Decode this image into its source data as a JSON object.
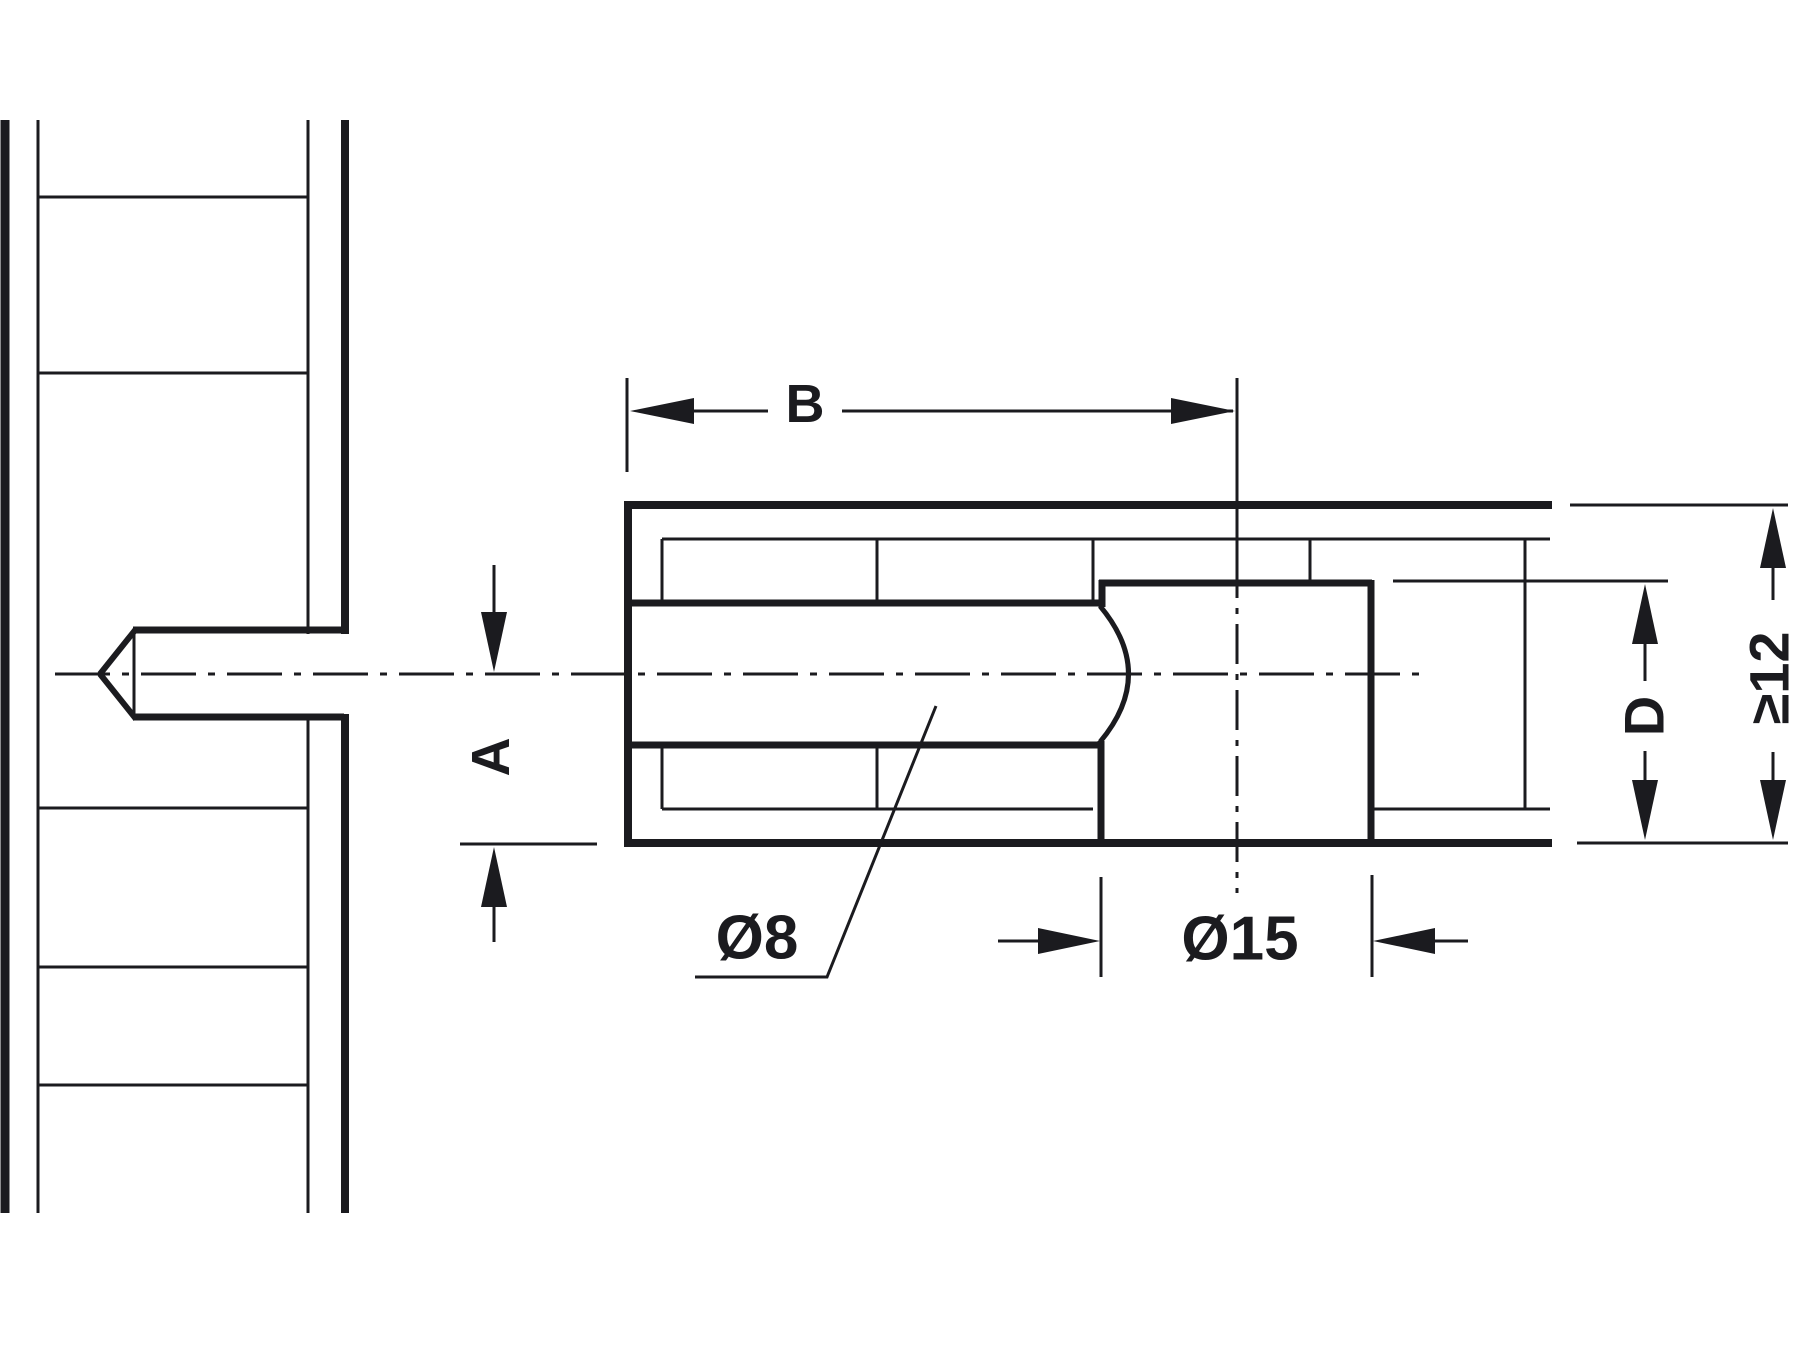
{
  "diagram": {
    "ink_color": "#1b1b1f",
    "background_color": "#ffffff",
    "labels": {
      "length_b": "B",
      "offset_a": "A",
      "depth_d": "D",
      "min_panel_thickness": "≥12",
      "bolt_hole_diameter": "Ø8",
      "cam_hole_diameter": "Ø15"
    }
  }
}
